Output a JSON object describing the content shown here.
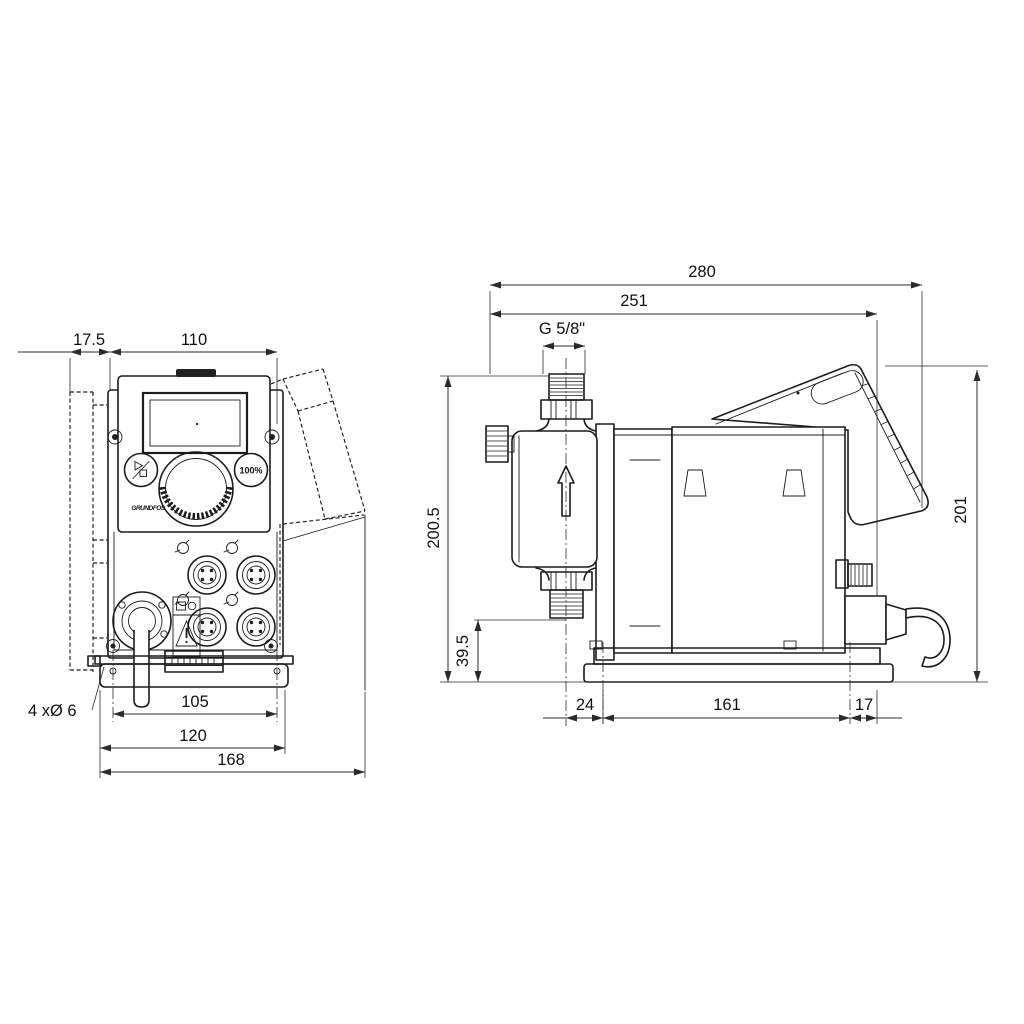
{
  "drawing": {
    "type": "technical-dimension-drawing",
    "front_view": {
      "dim_wall_offset": "17.5",
      "dim_width": "110",
      "hole_note": "4 xØ 6",
      "dim_hole_spacing": "105",
      "dim_plate_width": "120",
      "dim_overall_width": "168",
      "panel": {
        "button_100_label": "100%",
        "logo_text": "GRUNDFOS"
      }
    },
    "side_view": {
      "dim_overall_depth": "280",
      "dim_depth_to_cable": "251",
      "thread_label": "G 5/8\"",
      "dim_height_to_thread": "200.5",
      "dim_outlet_height": "39.5",
      "dim_front_overhang": "24",
      "dim_base_length": "161",
      "dim_rear_overhang": "17",
      "dim_overall_height": "201"
    }
  },
  "icons": {
    "start_stop": "play-stop-icon",
    "full_speed": "100-percent-button",
    "warning": "warning-triangle-icon",
    "flow_direction": "up-arrow-icon"
  },
  "colors": {
    "line": "#1c1c1c",
    "background": "#ffffff"
  }
}
